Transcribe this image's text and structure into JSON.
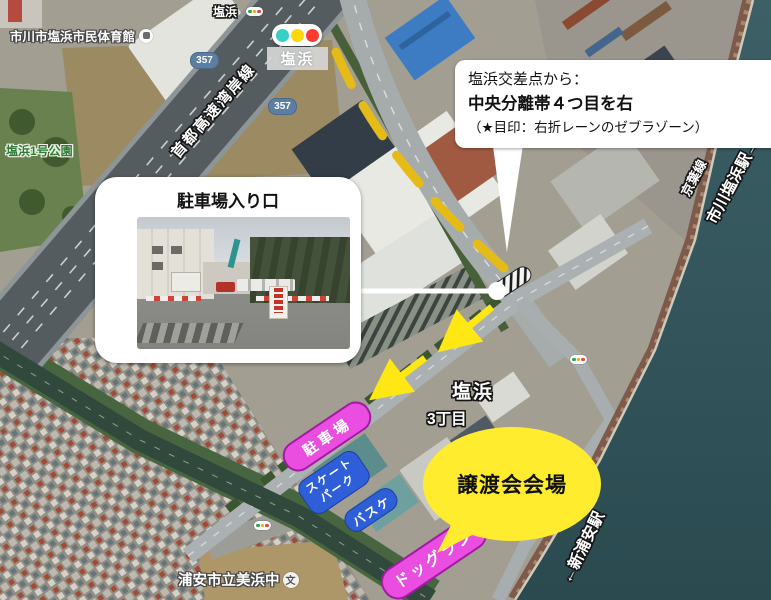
{
  "map": {
    "poi": {
      "gymnasium": "市川市塩浜市民体育館",
      "park": "塩浜1号公園",
      "school": "浦安市立美浜中",
      "school_symbol": "文",
      "intersection_name": "塩浜",
      "district": "3丁目",
      "signal_name": "塩浜",
      "station_area_label": "塩浜",
      "route_shield": "357",
      "expressway": "首都高速湾岸線",
      "rail_line": "京葉線",
      "station_right": "市川塩浜駅→",
      "station_bottom": "←新浦安駅"
    },
    "annotations": {
      "direction_note_line1": "塩浜交差点から：",
      "direction_note_line2": "中央分離帯４つ目を右",
      "direction_note_line3": "（★目印：右折レーンのゼブラゾーン）",
      "photo_title": "駐車場入り口",
      "venue_label": "譲渡会会場",
      "pill_parking": "駐車場",
      "pill_skate_line1": "スケート",
      "pill_skate_line2": "パーク",
      "pill_basketball": "バスケ",
      "pill_dogrun": "ドッグラン"
    },
    "colors": {
      "route_yellow": "#e5bb17",
      "arrow_yellow": "#ffe714",
      "bubble_yellow": "#ffec2e",
      "pill_magenta": "#e94ee0",
      "pill_blue": "#2e5ed8",
      "water_teal": "#31555b"
    }
  }
}
